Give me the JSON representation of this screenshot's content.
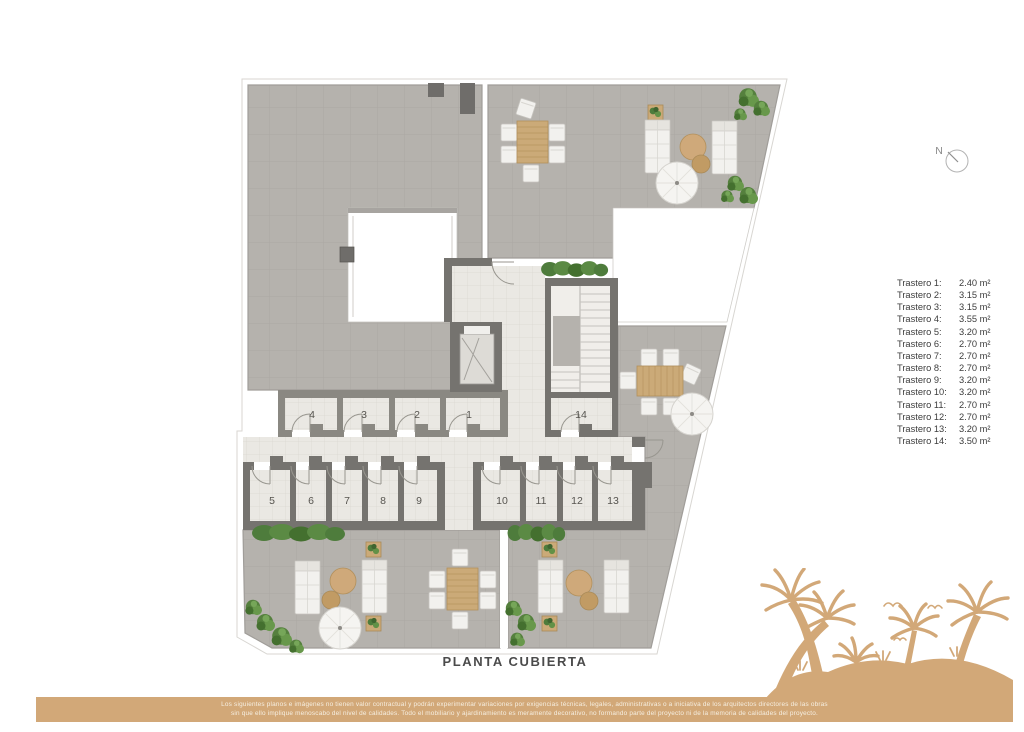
{
  "plan": {
    "title": "PLANTA CUBIERTA",
    "north_label": "N",
    "room_numbers": [
      "1",
      "2",
      "3",
      "4",
      "5",
      "6",
      "7",
      "8",
      "9",
      "10",
      "11",
      "12",
      "13",
      "14"
    ]
  },
  "legend": {
    "items": [
      {
        "label": "Trastero 1:",
        "area": "2.40 m²"
      },
      {
        "label": "Trastero 2:",
        "area": "3.15 m²"
      },
      {
        "label": "Trastero 3:",
        "area": "3.15 m²"
      },
      {
        "label": "Trastero 4:",
        "area": "3.55 m²"
      },
      {
        "label": "Trastero 5:",
        "area": "3.20 m²"
      },
      {
        "label": "Trastero 6:",
        "area": "2.70 m²"
      },
      {
        "label": "Trastero 7:",
        "area": "2.70 m²"
      },
      {
        "label": "Trastero 8:",
        "area": "2.70 m²"
      },
      {
        "label": "Trastero 9:",
        "area": "3.20 m²"
      },
      {
        "label": "Trastero 10:",
        "area": "3.20 m²"
      },
      {
        "label": "Trastero 11:",
        "area": "2.70 m²"
      },
      {
        "label": "Trastero 12:",
        "area": "2.70 m²"
      },
      {
        "label": "Trastero 13:",
        "area": "3.20 m²"
      },
      {
        "label": "Trastero 14:",
        "area": "3.50 m²"
      }
    ]
  },
  "footer": {
    "disclaimer_line1": "Los siguientes planos e imágenes no tienen valor contractual y podrán experimentar variaciones por exigencias técnicas, legales, administrativas o a iniciativa de los arquitectos directores de las obras",
    "disclaimer_line2": "sin que ello implique menoscabo del nivel de calidades. Todo el mobiliario y ajardinamiento es meramente decorativo, no formando parte del proyecto ni de la memoria de calidades del proyecto."
  },
  "colors": {
    "accent_tan": "#d2a878",
    "roof_tile": "#b5b2ad",
    "light_tile": "#eae8e3",
    "wall_dark": "#6f6d6a",
    "greenery": "#4e7c3c"
  }
}
